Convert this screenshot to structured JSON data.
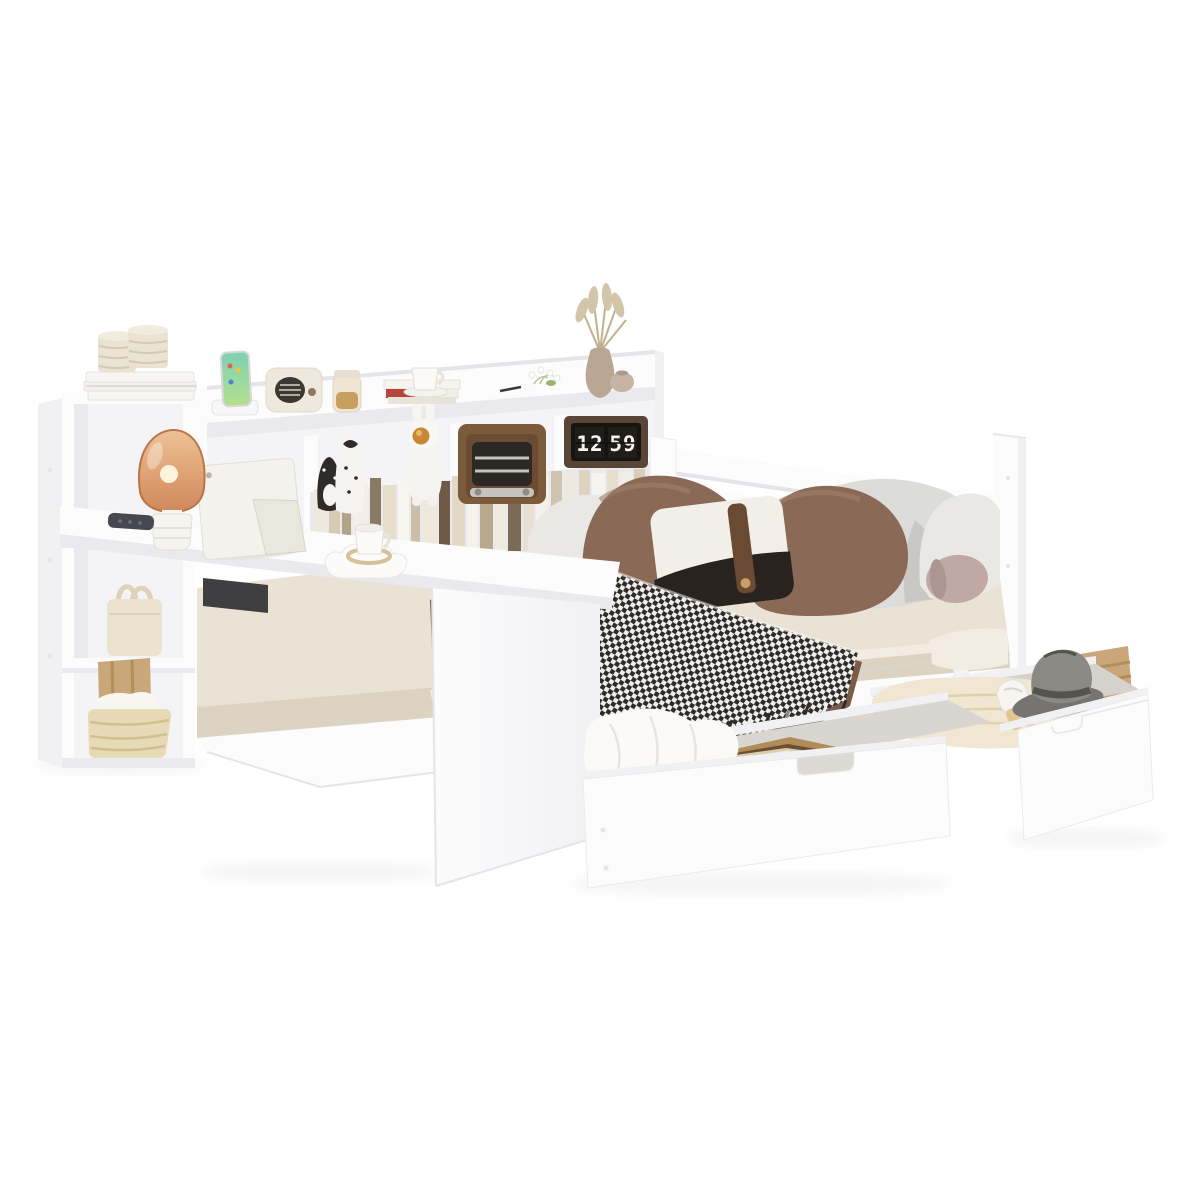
{
  "window": {
    "background": "#ffffff",
    "width": 1200,
    "height": 1200
  },
  "scene": {
    "type": "product-photo",
    "subject": "White wooden daybed with side bookcase headboard, integrated over-bed desk and two pull-out under-bed storage drawers, staged with decor",
    "flip_clock": {
      "hour": "12",
      "minute": "59",
      "display": "12:59"
    }
  },
  "objects": {
    "headboard_shelf_top": [
      "stacked white books with rope candles",
      "smartphone on dock",
      "cream retro speaker",
      "snack jar",
      "book stack with teacup",
      "white flowers",
      "pen",
      "pampas grass vase",
      "round vase"
    ],
    "headboard_shelf_middle": [
      "penguin figurines",
      "astronaut rabbit figurine",
      "wooden retro radio",
      "flip clock showing 12:59",
      "row of books"
    ],
    "storage_tower": [
      "cream handbag",
      "wooden box",
      "woven basket with towels"
    ],
    "desk": [
      "tablet with kickstand",
      "remote control",
      "amber mushroom lamp",
      "cloud tray with coffee cup"
    ],
    "bed": [
      "gray pillows",
      "brown pillows",
      "black and white accent pillow with leather strap",
      "mauve bolster cushion",
      "houndstooth throw with fringe",
      "brown blanket",
      "slatted side rail"
    ],
    "drawer_front": [
      "white duvet",
      "wooden picture frame"
    ],
    "drawer_right": [
      "knit blanket",
      "gray fedora hat",
      "rolled towel",
      "wooden crate"
    ]
  },
  "colors": {
    "white": "#ffffff",
    "panel": "#fcfcfd",
    "panelEdge": "#e4e4e9",
    "panelShade": "#f1f1f4",
    "panelDeep": "#e9e9ee",
    "interior": "#f4f4f7",
    "interiorShade": "#eaeaee",
    "darkGap": "#3f3e41",
    "shadow": "#ededf0",
    "sheet": "#eae2d4",
    "sheetDeep": "#ddd3c2",
    "sheetLight": "#f3ece1",
    "brown1": "#8a6a56",
    "brownDark": "#6f5442",
    "brownLight": "#9f8069",
    "blanket": "#7d5b49",
    "blanketDark": "#664a3a",
    "houndDark": "#2e2b28",
    "houndLight": "#efeeea",
    "fringe": "#8a8680",
    "gray1": "#dcdcda",
    "gray2": "#c9c8c5",
    "pillowWhite": "#e9e8e4",
    "accentWhite": "#f2efe8",
    "accentBlack": "#28231f",
    "strap": "#6b4a33",
    "button": "#c99f66",
    "bolster": "#c0a9a4",
    "bolsterDark": "#ac9692",
    "wood": "#8a6745",
    "woodLight": "#b08c58",
    "woodDark": "#6e4e30",
    "glass": "#d9cdb2",
    "glassLight": "#efe8d6",
    "amber": "#cf8352",
    "amberLight": "#eebf92",
    "amberDark": "#b76f3f",
    "glow": "#ffe3b0",
    "bulb": "#fff3dc",
    "lampBase": "#f6f4ef",
    "clockBox": "#584538",
    "clockCard": "#211d18",
    "digits": "#f4f4f2",
    "radioWood": "#7c5a3c",
    "radioFace": "#6b4c33",
    "grillDark": "#2c2824",
    "silver": "#c6c4bf",
    "cream": "#efe8dc",
    "speakerGrill": "#3b3733",
    "jarGlass": "#efe6d2",
    "jarFill": "#c89f5e",
    "phoneA": "#7ed0b4",
    "phoneB": "#b5e08c",
    "rope": "#eae3d4",
    "ropeLine": "#d5c9b0",
    "bag": "#ebe3d0",
    "bagLine": "#ddd2b8",
    "basket": "#e7dab6",
    "basketLine": "#d2c08e",
    "boxWood": "#c9a77a",
    "boxWoodLine": "#b28e58",
    "knit": "#f0e6d1",
    "knitLine": "#dfd0ae",
    "hat": "#757470",
    "hatLight": "#8a8984",
    "hatDark": "#54534e",
    "duvet": "#fbfaf7",
    "duvetShade": "#e8e5df",
    "towel": "#f8f6f1",
    "green": "#9db36a",
    "pampas": "#d3c5a9",
    "pampasLine": "#c2b190",
    "vase": "#b9a794",
    "vase2": "#c5b4a1",
    "remote": "#474750"
  }
}
